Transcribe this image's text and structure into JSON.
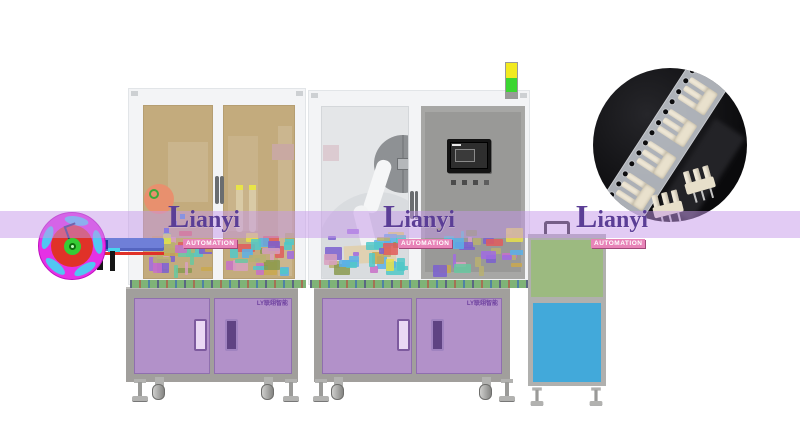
{
  "watermark": {
    "brand_initial": "L",
    "brand_rest": "ianyi",
    "sub": "AUTOMATION",
    "band_color": "rgba(197,152,233,0.5)"
  },
  "cabinets": {
    "label": "LY联翊智能"
  },
  "icons": {
    "inset_photo": "connector-carrier-tape-product-photo",
    "signal_tower": "machine-status-light",
    "reel": "tape-reel-feeder"
  },
  "colors": {
    "band": "rgba(197,152,233,0.5)",
    "brand_text": "#5b3e96",
    "brand_badge_bg": "#e884b8",
    "tan_window": "#c3ab7d",
    "gray_window": "#e4e6e8",
    "panel_gray": "#a7a7a5",
    "panel_inner": "#999997",
    "cabinet_frame": "#a19f9c",
    "cabinet_door": "#b291c9",
    "table_green": "#7fb377",
    "m3_green": "#9cba80",
    "m3_blue": "#42a9da",
    "signal_yellow": "#f2ea1f",
    "signal_green": "#3bd631",
    "reel_magenta": "#e531e5",
    "reel_red": "#e03228",
    "reel_hub_green": "#35cc35",
    "reel_slot_blue": "#52c6f2",
    "machinery_palette": [
      "#a06be0",
      "#caa84e",
      "#68c8a0",
      "#e05c5c",
      "#e8e04a",
      "#5ab0e8",
      "#c870c8",
      "#8a9a50",
      "#d8a0c0",
      "#50c8c8",
      "#7a5fd0",
      "#b8b070"
    ]
  }
}
